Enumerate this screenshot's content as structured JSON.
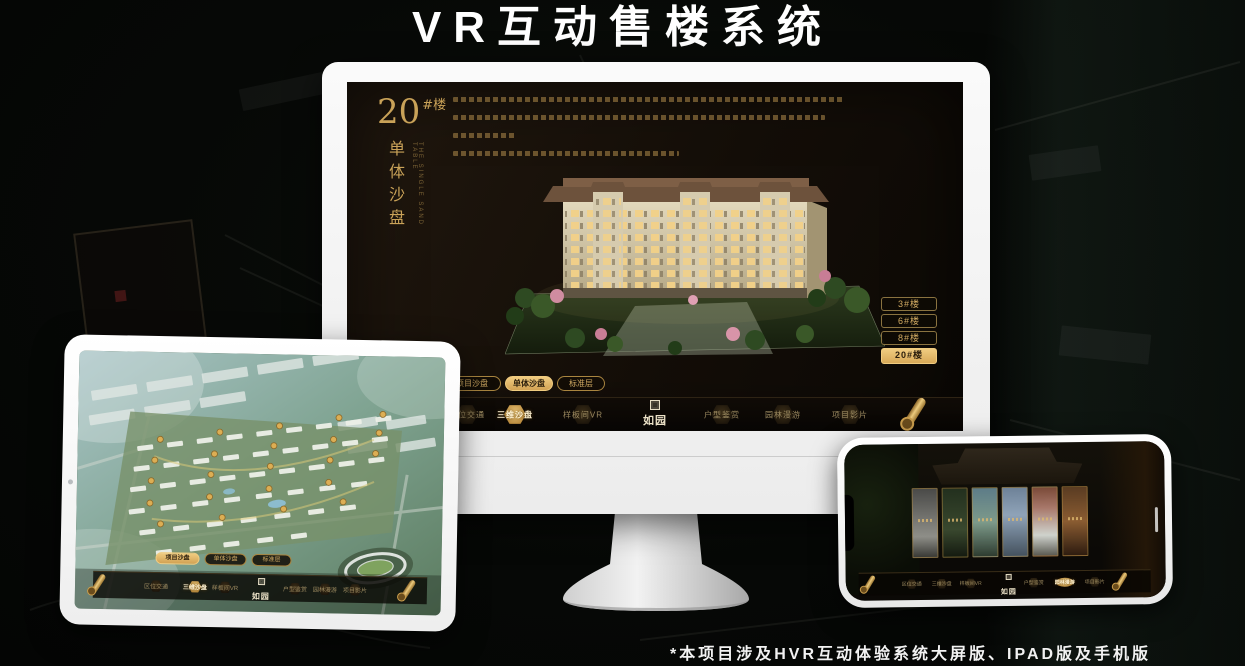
{
  "header": {
    "title": "VR互动售楼系统"
  },
  "footer": {
    "note": "*本项目涉及HVR互动体验系统大屏版、IPAD版及手机版"
  },
  "brand": {
    "logo_text": "如园"
  },
  "app_nav": {
    "left_items": [
      {
        "label": "区位交通"
      },
      {
        "label": "三维沙盘"
      },
      {
        "label": "样板间VR"
      }
    ],
    "right_items": [
      {
        "label": "户型鉴赏"
      },
      {
        "label": "园林漫游"
      },
      {
        "label": "项目影片"
      }
    ]
  },
  "monitor": {
    "heading": {
      "number": "20",
      "suffix": "#楼",
      "subtitle": "单体沙盘",
      "subtitle_en": "THE SINGLE SAND TABLE"
    },
    "floor_buttons": [
      {
        "label": "3#楼",
        "active": false
      },
      {
        "label": "6#楼",
        "active": false
      },
      {
        "label": "8#楼",
        "active": false
      },
      {
        "label": "20#楼",
        "active": true
      }
    ],
    "view_tabs": [
      {
        "label": "项目沙盘",
        "active": false
      },
      {
        "label": "单体沙盘",
        "active": true
      },
      {
        "label": "标准层",
        "active": false
      }
    ],
    "nav_active_label": "三维沙盘"
  },
  "tablet": {
    "view_tabs": [
      {
        "label": "项目沙盘",
        "active": true
      },
      {
        "label": "单体沙盘",
        "active": false
      },
      {
        "label": "标准层",
        "active": false
      }
    ],
    "nav_active_label": "三维沙盘"
  },
  "phone": {
    "nav_active_label": "园林漫游"
  },
  "colors": {
    "gold_accent": "#d2ab63",
    "gold_active": "#e8c06c",
    "screen_background": "#17110a",
    "title_text": "#ffffff"
  }
}
